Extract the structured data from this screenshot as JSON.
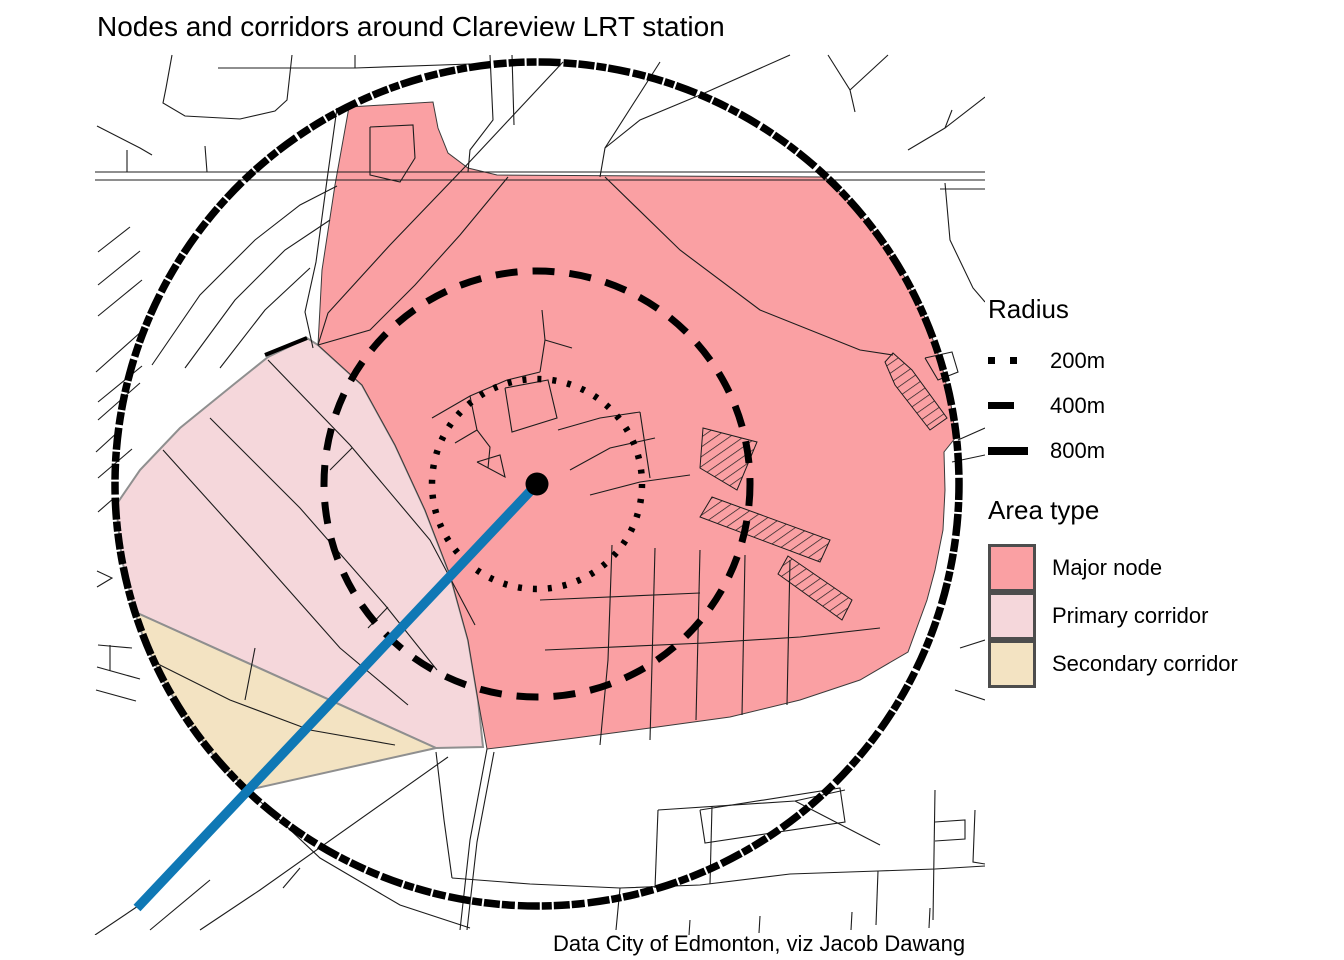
{
  "title": "Nodes and corridors around Clareview LRT station",
  "caption": "Data City of Edmonton, viz Jacob Dawang",
  "legend_radius": {
    "title": "Radius",
    "items": [
      {
        "label": "200m",
        "swatch": "dots"
      },
      {
        "label": "400m",
        "swatch": "dash"
      },
      {
        "label": "800m",
        "swatch": "solid"
      }
    ]
  },
  "legend_area": {
    "title": "Area type",
    "items": [
      {
        "label": "Major node",
        "color": "#FAA0A3"
      },
      {
        "label": "Primary corridor",
        "color": "#F5D7DB"
      },
      {
        "label": "Secondary corridor",
        "color": "#F3E3C2"
      }
    ]
  },
  "colors": {
    "major_node": "#FAA0A3",
    "primary_corridor": "#F5D7DB",
    "secondary_corridor": "#F3E3C2",
    "lrt_line": "#0F78B5",
    "roads": "#1c1c1c",
    "rings": "#000000"
  },
  "map": {
    "center": {
      "x": 537,
      "y": 484,
      "dot_radius": 11.5
    },
    "rings": [
      {
        "label": "200m",
        "r": 105,
        "class": "ring-200"
      },
      {
        "label": "400m",
        "r": 213,
        "class": "ring-400"
      },
      {
        "label": "800m",
        "r": 422,
        "class": "ring-800"
      }
    ],
    "lrt_line": {
      "x1": 537,
      "y1": 484,
      "x2": 137,
      "y2": 908
    },
    "regions": [
      {
        "name": "primary-corridor",
        "class": "region-primary-corridor",
        "points": "318,345 362,385 395,445 425,510 450,575 468,640 478,700 483,747 436,748 135,612 122,560 116,505 140,470 180,428 233,385 268,357 307,338"
      },
      {
        "name": "secondary-corridor",
        "class": "region-secondary-corridor",
        "points": "135,612 436,748 248,790 217,760 187,720 163,680 144,640"
      },
      {
        "name": "major-node",
        "class": "region-major-node",
        "points": "349,107 433,102 438,128 448,153 468,168 497,175 825,177 853,205 879,238 904,276 925,318 941,362 951,405 956,437 944,452 945,490 943,530 935,570 927,600 908,652 860,680 800,700 730,717 650,728 575,738 520,745 487,749 478,700 468,640 450,575 425,510 395,445 362,385 318,345 322,270 335,185"
      }
    ],
    "roads": [
      "172,55 166,88 163,103 185,116 240,119 275,111 287,100 292,55",
      "218,68 355,68 355,55",
      "355,68 470,64",
      "97,126 140,148 152,155",
      "127,150 127,172",
      "205,146 207,172",
      "490,55 493,120 470,150 468,172",
      "512,55 514,125",
      "563,62 462,170",
      "660,62 605,148 600,177",
      "790,55 700,95 640,120 605,148",
      "828,55 850,90 855,112",
      "888,55 850,90",
      "985,97 945,128 908,150",
      "945,128 952,110",
      "95,172 985,172",
      "95,180 985,180",
      "940,189 985,189",
      "945,183 950,240 973,288 985,302",
      "98,252 130,227",
      "98,285 140,251",
      "98,316 142,280",
      "96,372 142,331",
      "98,402 142,366",
      "98,420 140,383",
      "120,430 96,452",
      "98,478 132,449",
      "98,512 114,498",
      "97,571 112,578 97,587",
      "98,645 132,648",
      "110,645 110,671",
      "97,667 140,679",
      "96,690 136,701",
      "152,365 200,295 255,240 300,205 337,186",
      "185,368 235,300 285,250 330,220",
      "220,368 265,310 310,268",
      "337,108 327,180 316,262 305,312 313,348",
      "462,170 390,245 328,313 318,345",
      "508,177 460,235 415,285 370,330 318,345",
      "605,177 680,250 760,310 860,350 893,355",
      "432,418 470,396 507,380 540,372",
      "540,372 545,340 542,310",
      "545,340 572,348",
      "470,396 477,430 490,447 488,468",
      "477,430 455,443",
      "558,430 600,418 640,412",
      "570,470 610,448 655,438",
      "590,495 640,482 690,475",
      "640,412 650,478",
      "540,600 700,593",
      "545,650 705,643",
      "612,545 608,660 600,745",
      "655,548 650,740",
      "700,550 696,720",
      "745,555 742,715",
      "790,560 787,705",
      "705,643 800,637 880,628",
      "268,360 350,445 430,540 475,625",
      "210,418 300,508 385,605 437,670",
      "163,450 255,552 340,648 408,705",
      "352,448 330,470",
      "388,607 368,628",
      "150,660 230,700 310,730 395,745",
      "255,648 245,700",
      "487,749 470,840 460,930",
      "494,752 477,842 467,930",
      "436,752 444,820 452,878",
      "452,878 530,884 620,888 700,885 790,874 878,871 935,869 985,866",
      "658,810 655,888",
      "712,806 710,884",
      "700,810 840,788 845,822 705,843 700,810",
      "658,810 795,801 845,790",
      "795,801 880,845",
      "935,790 933,920",
      "935,822 965,820 965,839 935,841",
      "975,810 973,862 985,864",
      "878,871 876,925",
      "620,888 616,930",
      "690,920 689,935",
      "760,916 759,933",
      "852,912 851,930",
      "930,908 929,928",
      "448,757 260,890 200,930",
      "248,790 320,858 400,905 470,928",
      "150,930 210,880",
      "95,935 150,898",
      "300,868 283,888",
      "958,440 985,428",
      "952,462 985,455",
      "960,648 985,640",
      "955,690 985,700",
      "370,127 413,125 415,158 400,182 370,175 370,127",
      "505,388 548,380 557,418 512,432 505,388",
      "477,462 500,455 505,477 477,462",
      "925,358 952,352 958,372 938,380 925,358"
    ],
    "thick_roads": [
      "265,355 307,338"
    ],
    "hatches": [
      "893,353 912,370 947,418 930,430 895,385 885,362",
      "703,428 757,442 737,490 700,468",
      "712,497 830,540 820,562 700,517",
      "788,556 852,600 842,620 778,574"
    ]
  }
}
